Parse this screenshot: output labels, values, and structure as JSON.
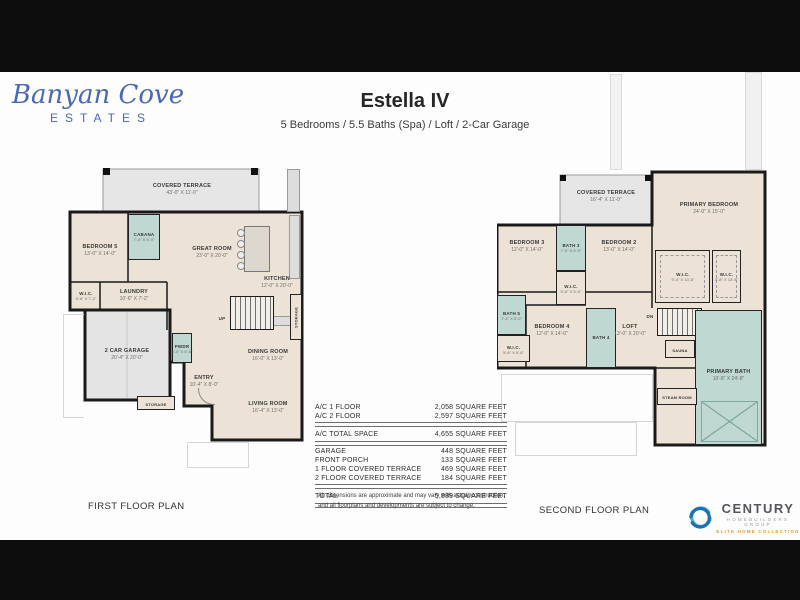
{
  "brand": {
    "name": "Banyan Cove",
    "tagline": "ESTATES"
  },
  "header": {
    "title": "Estella IV",
    "subtitle": "5 Bedrooms / 5.5 Baths (Spa) / Loft  /  2-Car Garage"
  },
  "first_floor": {
    "caption": "FIRST FLOOR PLAN",
    "rooms": {
      "terrace": {
        "name": "COVERED TERRACE",
        "dims": "43'-0\" X 11'-0\""
      },
      "great": {
        "name": "GREAT ROOM",
        "dims": "23'-0\" X 20'-0\""
      },
      "kitchen": {
        "name": "KITCHEN",
        "dims": "12'-0\" X 20'-0\""
      },
      "bed5": {
        "name": "BEDROOM 5",
        "dims": "13'-0\" X 14'-0\""
      },
      "cabana": {
        "name": "CABANA",
        "dims": "7'-4\" X 5'-0\""
      },
      "wic": {
        "name": "W.I.C.",
        "dims": "5'-8\" X 7'-2\""
      },
      "laundry": {
        "name": "LAUNDRY",
        "dims": "10'-6\" X 7'-2\""
      },
      "garage": {
        "name": "2 CAR GARAGE",
        "dims": "20'-4\" X 20'-0\""
      },
      "pwdr": {
        "name": "PWDR",
        "dims": "5'-0\" X 5'-6\""
      },
      "entry": {
        "name": "ENTRY",
        "dims": "10'-4\" X 8'-0\""
      },
      "dining": {
        "name": "DINING ROOM",
        "dims": "16'-0\" X 13'-0\""
      },
      "living": {
        "name": "LIVING ROOM",
        "dims": "16'-4\" X 13'-0\""
      },
      "storage1": {
        "name": "STORAGE"
      },
      "storage2": {
        "name": "STORAGE"
      },
      "up": "UP"
    }
  },
  "second_floor": {
    "caption": "SECOND FLOOR PLAN",
    "rooms": {
      "terrace": {
        "name": "COVERED TERRACE",
        "dims": "16'-4\" X 11'-0\""
      },
      "primary": {
        "name": "PRIMARY BEDROOM",
        "dims": "24'-0\" X 15'-0\""
      },
      "bed3": {
        "name": "BEDROOM 3",
        "dims": "12'-0\" X 14'-0\""
      },
      "bath3": {
        "name": "BATH 3",
        "dims": "7'-0\" X 5'-0\""
      },
      "bed2": {
        "name": "BEDROOM 2",
        "dims": "13'-0\" X 14'-0\""
      },
      "wic_hall": {
        "name": "W.I.C.",
        "dims": "5'-8\" X 5'-0\""
      },
      "wic_primary_a": {
        "name": "W.I.C.",
        "dims": "9'-4\" X 13'-8\""
      },
      "wic_primary_b": {
        "name": "W.I.C.",
        "dims": "3'-8\" X 13'-8\""
      },
      "bath5": {
        "name": "BATH 5",
        "dims": "7'-4\" X 5'-0\""
      },
      "wic_bed4": {
        "name": "W.I.C.",
        "dims": "5'-8\" X 5'-8\""
      },
      "bed4": {
        "name": "BEDROOM 4",
        "dims": "12'-0\" X 14'-0\""
      },
      "bath4": {
        "name": "BATH 4"
      },
      "loft": {
        "name": "LOFT",
        "dims": "13'-0\" X 20'-0\""
      },
      "sauna": {
        "name": "SAUNA"
      },
      "primary_bath": {
        "name": "PRIMARY BATH",
        "dims": "10'-8\" X 24'-8\""
      },
      "steam": {
        "name": "STEAM ROOM"
      },
      "dn": "DN"
    }
  },
  "spec_table": {
    "rows": [
      {
        "label": "A/C 1 FLOOR",
        "value": "2,058 SQUARE FEET"
      },
      {
        "label": "A/C 2 FLOOR",
        "value": "2,597 SQUARE FEET"
      },
      {
        "label": "A/C TOTAL SPACE",
        "value": "4,655 SQUARE FEET"
      },
      {
        "label": "GARAGE",
        "value": "448 SQUARE FEET"
      },
      {
        "label": "FRONT PORCH",
        "value": "133 SQUARE FEET"
      },
      {
        "label": "1 FLOOR COVERED TERRACE",
        "value": "469 SQUARE FEET"
      },
      {
        "label": "2 FLOOR COVERED TERRACE",
        "value": "184 SQUARE FEET"
      },
      {
        "label": "TOTAL",
        "value": "5,889 SQUARE FEET"
      }
    ]
  },
  "disclaimer": "All dimensions are approximate and may vary with actual construction, and all floorplans and developments are subject to change.",
  "century": {
    "name": "CENTURY",
    "group": "HOMEBUILDERS GROUP",
    "collection": "ELITE HOME COLLECTION"
  },
  "colors": {
    "logo_blue": "#4a69b2",
    "floor_beige": "#ece3d6",
    "bath_teal": "#bfd8d2",
    "century_blue": "#2d9fd8",
    "century_orange": "#dd9a33"
  }
}
